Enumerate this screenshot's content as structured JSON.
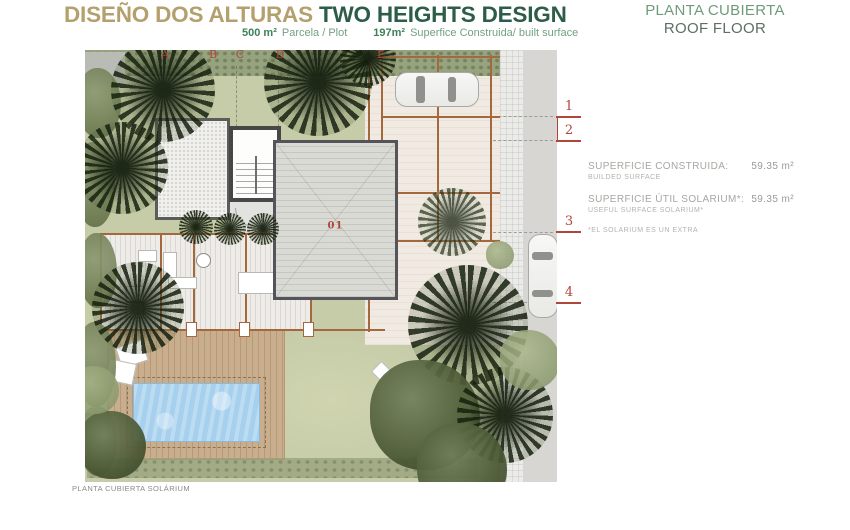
{
  "header": {
    "title_es": "DISEÑO DOS ALTURAS",
    "title_en": " TWO HEIGHTS DESIGN",
    "subtitle": {
      "plot_value": "500 m²",
      "plot_label": "Parcela / Plot",
      "built_value": "197m²",
      "built_label": "Superfice Construida/ built surface"
    },
    "right_title_es": "PLANTA CUBIERTA",
    "right_title_en": "ROOF FLOOR"
  },
  "info_panel": {
    "rows": [
      {
        "label": "SUPERFICIE CONSTRUIDA:",
        "sublabel": "BUILDED SURFACE",
        "value": "59.35 m²"
      },
      {
        "label": "SUPERFICIE ÚTIL SOLARIUM*:",
        "sublabel": "USEFUL SURFACE SOLARIUM*",
        "value": "59.35 m²"
      }
    ],
    "footnote": "*EL SOLARIUM ES UN EXTRA"
  },
  "plan": {
    "grid_letters": [
      "A",
      "B",
      "C",
      "D",
      "E"
    ],
    "grid_numbers": [
      "1",
      "2",
      "3",
      "4"
    ],
    "room_label": "01",
    "caption": "PLANTA CUBIERTA SOLÁRIUM"
  },
  "colors": {
    "title_tan": "#b3a06c",
    "title_green": "#2d5c49",
    "subtitle_green": "#72a182",
    "right_title_green": "#6f9b7a",
    "grid_red": "#b0463a",
    "info_gray": "#a7a6a2",
    "grass_green": "#c6cba8",
    "pool_blue": "#a6d0ee",
    "pergola_brown": "#a4683f",
    "deck_tan": "#c9ae8e",
    "roof_gray": "#dadad5"
  }
}
